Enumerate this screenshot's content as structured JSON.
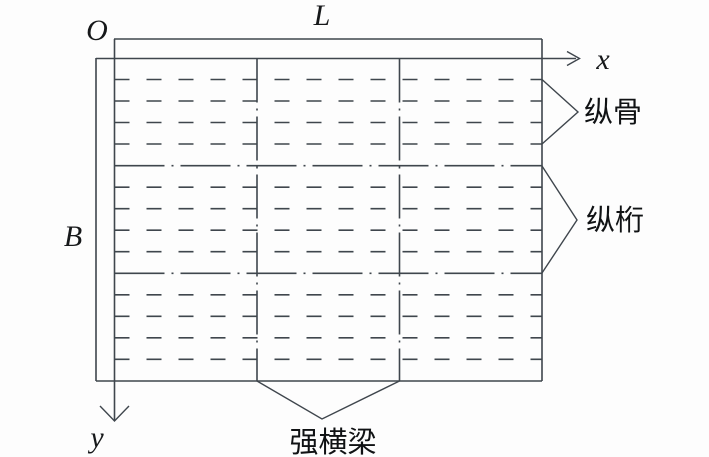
{
  "figure": {
    "background": "#fdfdfd",
    "line_color": "#3f464d",
    "text_color": "#16181a",
    "labels": {
      "origin": "O",
      "x_axis": "x",
      "y_axis": "y",
      "length": "L",
      "breadth": "B",
      "stiffener": "纵骨",
      "girder": "纵桁",
      "beam": "强横梁"
    },
    "geometry": {
      "canvas": [
        709,
        457
      ],
      "solid_lines": [
        [
          114,
          39,
          542,
          39
        ],
        [
          542,
          39,
          542,
          381
        ],
        [
          96,
          381,
          542,
          381
        ],
        [
          96,
          58,
          96,
          381
        ]
      ],
      "axes": {
        "x": {
          "line": [
            96,
            58.5,
            576,
            58.5
          ],
          "arrow_head": [
            [
              567,
              51.5
            ],
            [
              579.5,
              58.5
            ],
            [
              567,
              65.5
            ]
          ]
        },
        "y": {
          "line": [
            114.5,
            39,
            114.5,
            420
          ],
          "arrow_head": [
            [
              100,
              406
            ],
            [
              114.5,
              421
            ],
            [
              129,
              406
            ]
          ]
        }
      },
      "beams": {
        "x": [
          257,
          399.5
        ],
        "y1": 58.5,
        "y2": 381,
        "dash": "44 6 2 6"
      },
      "girders": {
        "y": [
          165.7,
          273.3
        ],
        "x1": 114.5,
        "x2": 542,
        "dash": "50 7 2 7"
      },
      "stiffeners": {
        "y": [
          79.5,
          101,
          122.5,
          144,
          187.2,
          208.7,
          230.2,
          251.7,
          294.8,
          316.3,
          337.8,
          359.3
        ],
        "x1": 114.5,
        "x2": 542,
        "dash": "15 17"
      },
      "callouts": [
        {
          "name": "stiffener",
          "points": [
            [
              542,
              79.5
            ],
            [
              578,
              112
            ],
            [
              542,
              144
            ]
          ]
        },
        {
          "name": "girder",
          "points": [
            [
              542,
              166
            ],
            [
              577,
              220
            ],
            [
              542,
              273
            ]
          ]
        },
        {
          "name": "beam",
          "points": [
            [
              257,
              381
            ],
            [
              322,
              419
            ],
            [
              399.5,
              381
            ]
          ]
        }
      ]
    }
  }
}
